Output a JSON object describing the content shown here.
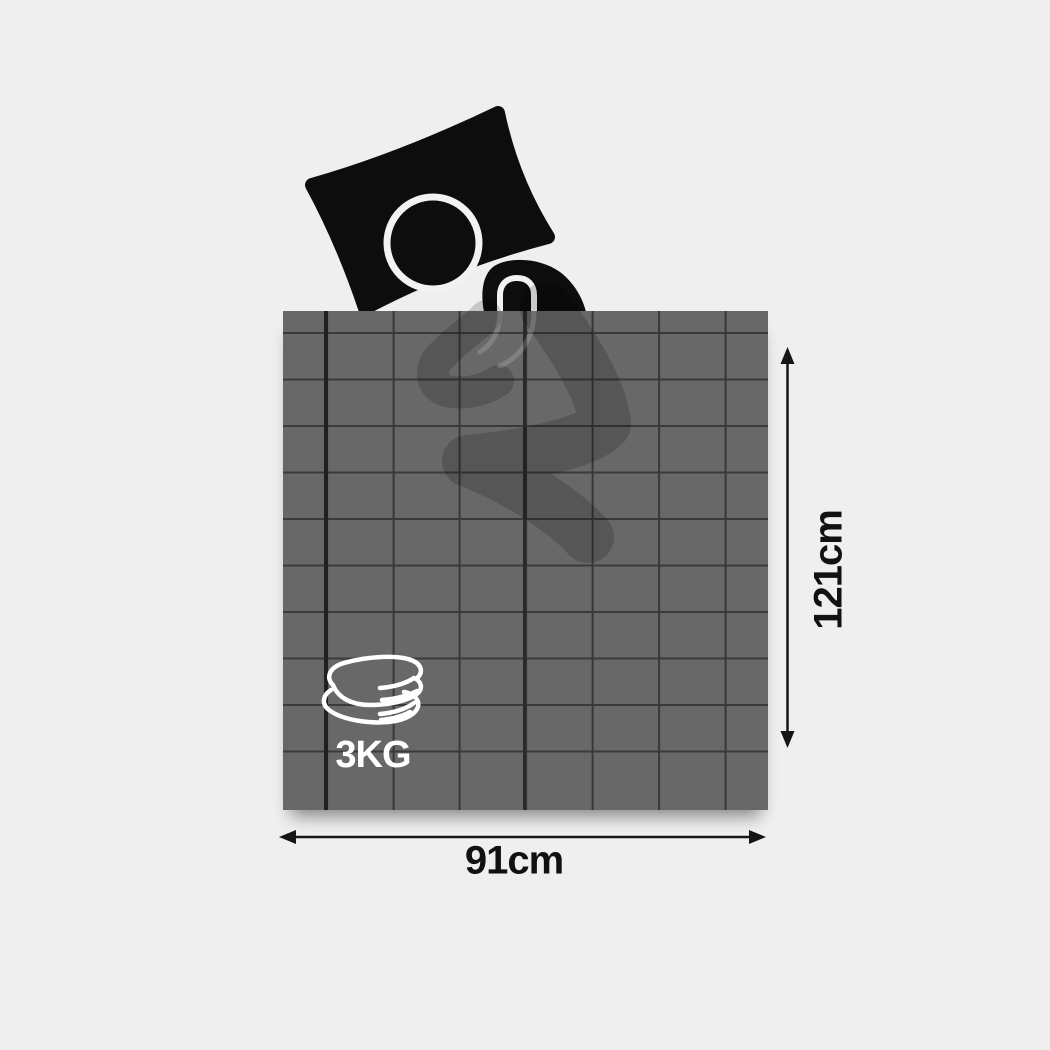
{
  "diagram": {
    "type": "weighted-blanket product dimension diagram",
    "dimensions": {
      "height_label": "121cm",
      "width_label": "91cm"
    },
    "weight": {
      "label": "3KG"
    },
    "icons": {
      "sleeping_person": "sleeping-person-icon",
      "folded_blanket": "folded-blanket-icon",
      "height_arrow": "vertical-dimension-arrow",
      "width_arrow": "horizontal-dimension-arrow"
    },
    "colors": {
      "background": "#efefef",
      "blanket": "#686868",
      "grid_line": "#383838",
      "figure": "#0d0d0d",
      "label_text": "#111111",
      "weight_text": "#ffffff"
    }
  }
}
